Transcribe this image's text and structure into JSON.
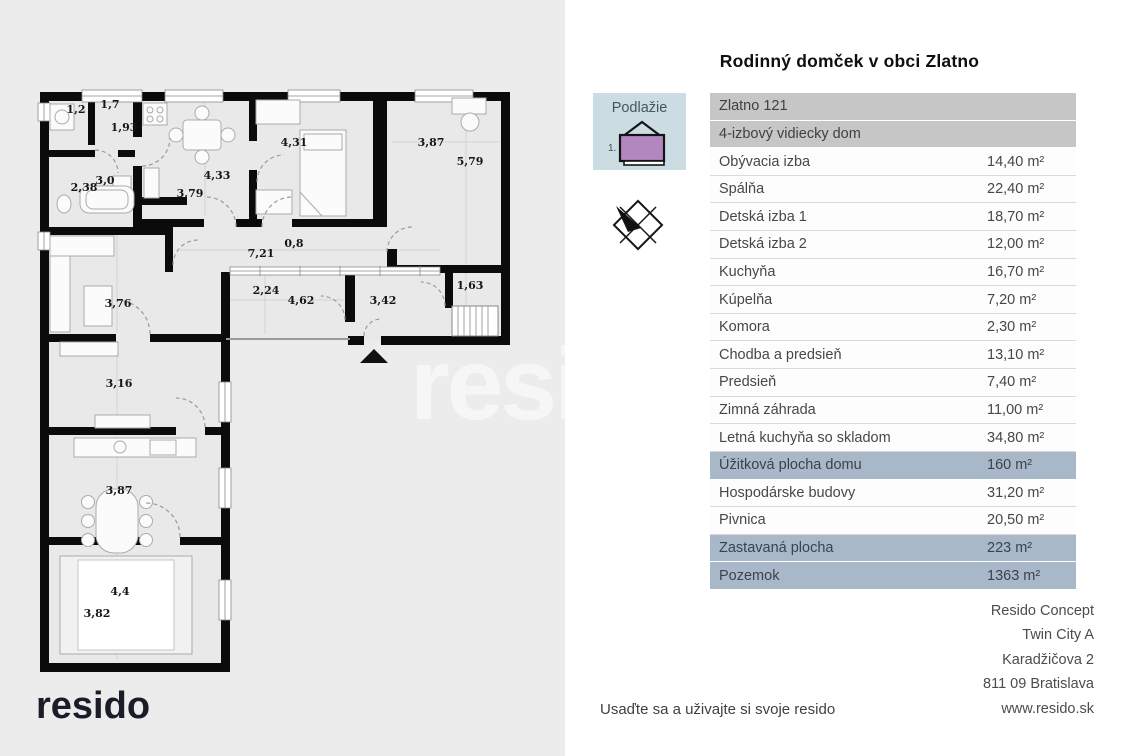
{
  "header": {
    "title": "Rodinný domček v obci Zlatno"
  },
  "floor_badge": {
    "label": "Podlažie",
    "floor_number": "1."
  },
  "area_table": {
    "rows": [
      {
        "label": "Zlatno 121",
        "value": "",
        "type": "header"
      },
      {
        "label": "4-izbový vidiecky dom",
        "value": "",
        "type": "header"
      },
      {
        "label": "Obývacia izba",
        "value": "14,40 m²",
        "type": "normal"
      },
      {
        "label": "Spálňa",
        "value": "22,40 m²",
        "type": "normal"
      },
      {
        "label": "Detská izba 1",
        "value": "18,70 m²",
        "type": "normal"
      },
      {
        "label": "Detská izba 2",
        "value": "12,00 m²",
        "type": "normal"
      },
      {
        "label": "Kuchyňa",
        "value": "16,70 m²",
        "type": "normal"
      },
      {
        "label": "Kúpelňa",
        "value": "7,20 m²",
        "type": "normal"
      },
      {
        "label": "Komora",
        "value": "2,30 m²",
        "type": "normal"
      },
      {
        "label": "Chodba a predsieň",
        "value": "13,10 m²",
        "type": "normal"
      },
      {
        "label": "Predsieň",
        "value": "7,40 m²",
        "type": "normal"
      },
      {
        "label": "Zimná záhrada",
        "value": "11,00 m²",
        "type": "normal"
      },
      {
        "label": "Letná kuchyňa so skladom",
        "value": "34,80 m²",
        "type": "normal"
      },
      {
        "label": "Úžitková plocha domu",
        "value": "160 m²",
        "type": "highlight"
      },
      {
        "label": "Hospodárske budovy",
        "value": "31,20 m²",
        "type": "normal"
      },
      {
        "label": "Pivnica",
        "value": "20,50 m²",
        "type": "normal"
      },
      {
        "label": "Zastavaná plocha",
        "value": "223 m²",
        "type": "highlight"
      },
      {
        "label": "Pozemok",
        "value": "1363 m²",
        "type": "highlight"
      }
    ]
  },
  "floor_plan": {
    "dimension_labels": [
      {
        "text": "1,2",
        "x": 76,
        "y": 113
      },
      {
        "text": "1,7",
        "x": 110,
        "y": 108
      },
      {
        "text": "1,93",
        "x": 124,
        "y": 131
      },
      {
        "text": "3,0",
        "x": 105,
        "y": 184
      },
      {
        "text": "2,38",
        "x": 84,
        "y": 191
      },
      {
        "text": "4,33",
        "x": 217,
        "y": 179
      },
      {
        "text": "3,79",
        "x": 190,
        "y": 197
      },
      {
        "text": "4,31",
        "x": 294,
        "y": 146
      },
      {
        "text": "3,87",
        "x": 431,
        "y": 146
      },
      {
        "text": "5,79",
        "x": 470,
        "y": 165
      },
      {
        "text": "0,8",
        "x": 294,
        "y": 247
      },
      {
        "text": "7,21",
        "x": 261,
        "y": 257
      },
      {
        "text": "2,24",
        "x": 266,
        "y": 294
      },
      {
        "text": "4,62",
        "x": 301,
        "y": 304
      },
      {
        "text": "3,42",
        "x": 383,
        "y": 304
      },
      {
        "text": "1,63",
        "x": 470,
        "y": 289
      },
      {
        "text": "3,76",
        "x": 118,
        "y": 307
      },
      {
        "text": "3,16",
        "x": 119,
        "y": 387
      },
      {
        "text": "3,87",
        "x": 119,
        "y": 494
      },
      {
        "text": "4,4",
        "x": 120,
        "y": 595
      },
      {
        "text": "3,82",
        "x": 97,
        "y": 617
      }
    ]
  },
  "watermark": {
    "text": "resido"
  },
  "branding": {
    "logo_text": "resido"
  },
  "footer": {
    "tagline": "Usaďte sa a uživajte si svoje resido"
  },
  "contact": {
    "lines": [
      "Resido Concept",
      "Twin City A",
      "Karadžičova 2",
      "811 09 Bratislava",
      "www.resido.sk"
    ]
  },
  "colors": {
    "panel_bg": "#ececec",
    "header_row_bg": "#c6c6c6",
    "highlight_row_bg": "#a9b8c9",
    "badge_bg": "#cbdce2",
    "house_fill": "#b287bf"
  }
}
